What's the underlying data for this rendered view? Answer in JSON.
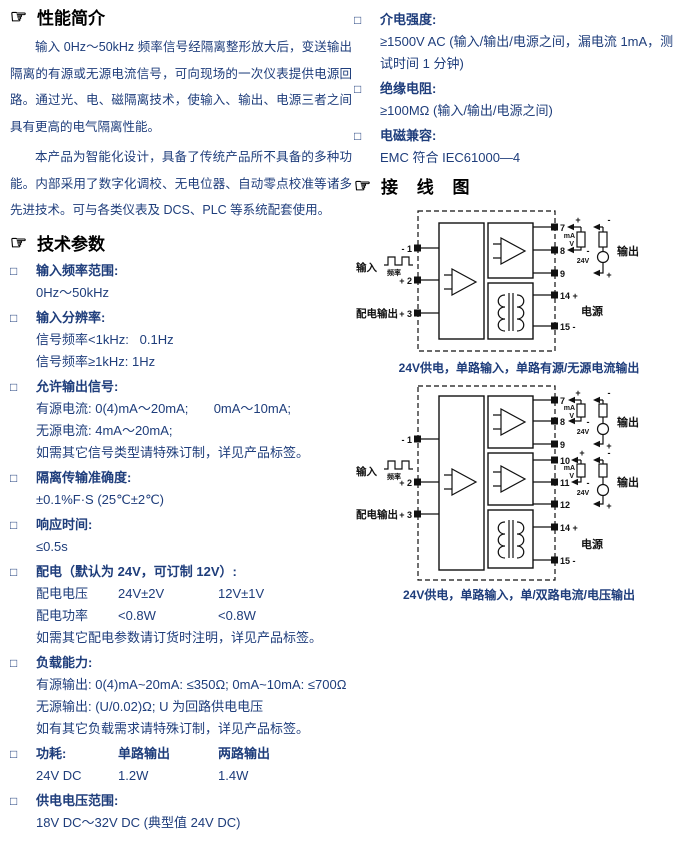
{
  "colors": {
    "body_blue": "#1e3d7b",
    "heading_black": "#000000",
    "diagram_black": "#111111"
  },
  "left_column": {
    "intro": {
      "icon": "☞",
      "title": "性能简介",
      "paragraphs": [
        "输入 0Hz～50kHz 频率信号经隔离整形放大后，变送输出隔离的有源或无源电流信号，可向现场的一次仪表提供电源回路。通过光、电、磁隔离技术，使输入、输出、电源三者之间具有更高的电气隔离性能。",
        "本产品为智能化设计，具备了传统产品所不具备的多种功能。内部采用了数字化调校、无电位器、自动零点校准等诸多先进技术。可与各类仪表及 DCS、PLC 等系统配套使用。"
      ]
    },
    "tech": {
      "icon": "☞",
      "title": "技术参数",
      "bullet": "□",
      "items": [
        {
          "label": "输入频率范围:",
          "lines": [
            "0Hz～50kHz"
          ]
        },
        {
          "label": "输入分辨率:",
          "lines": [
            "信号频率<1kHz:   0.1Hz",
            "信号频率≥1kHz: 1Hz"
          ]
        },
        {
          "label": "允许输出信号:",
          "lines": [
            "有源电流: 0(4)mA～20mA;       0mA～10mA;",
            "无源电流: 4mA～20mA;",
            "如需其它信号类型请特殊订制，详见产品标签。"
          ]
        },
        {
          "label": "隔离传输准确度:",
          "lines": [
            "±0.1%F·S (25℃±2℃)"
          ]
        },
        {
          "label": "响应时间:",
          "lines": [
            "≤0.5s"
          ]
        },
        {
          "label": "配电（默认为 24V，可订制 12V）:",
          "table": [
            [
              "配电电压",
              "24V±2V",
              "12V±1V"
            ],
            [
              "配电功率",
              "<0.8W",
              "<0.8W"
            ]
          ],
          "lines": [
            "如需其它配电参数请订货时注明，详见产品标签。"
          ]
        },
        {
          "label": "负载能力:",
          "lines": [
            "有源输出: 0(4)mA~20mA: ≤350Ω; 0mA~10mA: ≤700Ω",
            "无源输出: (U/0.02)Ω; U 为回路供电电压",
            "如有其它负载需求请特殊订制，详见产品标签。"
          ]
        },
        {
          "label": "功耗:",
          "header_cols": [
            "单路输出",
            "两路输出"
          ],
          "row": [
            "24V DC",
            "1.2W",
            "1.4W"
          ]
        },
        {
          "label": "供电电压范围:",
          "lines": [
            "18V DC～32V DC (典型值 24V DC)"
          ]
        }
      ]
    }
  },
  "right_column": {
    "specs": {
      "bullet": "□",
      "items": [
        {
          "label": "介电强度:",
          "lines": [
            "≥1500V AC (输入/输出/电源之间，漏电流 1mA，测试时间 1 分钟)"
          ]
        },
        {
          "label": "绝缘电阻:",
          "lines": [
            "≥100MΩ (输入/输出/电源之间)"
          ]
        },
        {
          "label": "电磁兼容:",
          "lines": [
            "EMC 符合 IEC61000—4"
          ]
        }
      ]
    },
    "wiring": {
      "icon": "☞",
      "title": "接 线 图",
      "labels": {
        "input": "输入",
        "freq": "频率",
        "aux_out": "配电输出",
        "output": "输出",
        "power": "电源",
        "v24": "24V",
        "ma": "mA",
        "volt": "V",
        "plus": "+",
        "minus": "-"
      },
      "diagram1": {
        "caption": "24V供电，单路输入，单路有源/无源电流输出",
        "left_terminals": [
          "- 1",
          "+ 2",
          "+ 3"
        ],
        "right_terminals": [
          "7",
          "8",
          "9",
          "14 +",
          "15 -"
        ]
      },
      "diagram2": {
        "caption": "24V供电，单路输入，单/双路电流/电压输出",
        "left_terminals": [
          "- 1",
          "+ 2",
          "+ 3"
        ],
        "right_terminals": [
          "7",
          "8",
          "9",
          "10",
          "11",
          "12",
          "14 +",
          "15 -"
        ]
      }
    }
  }
}
